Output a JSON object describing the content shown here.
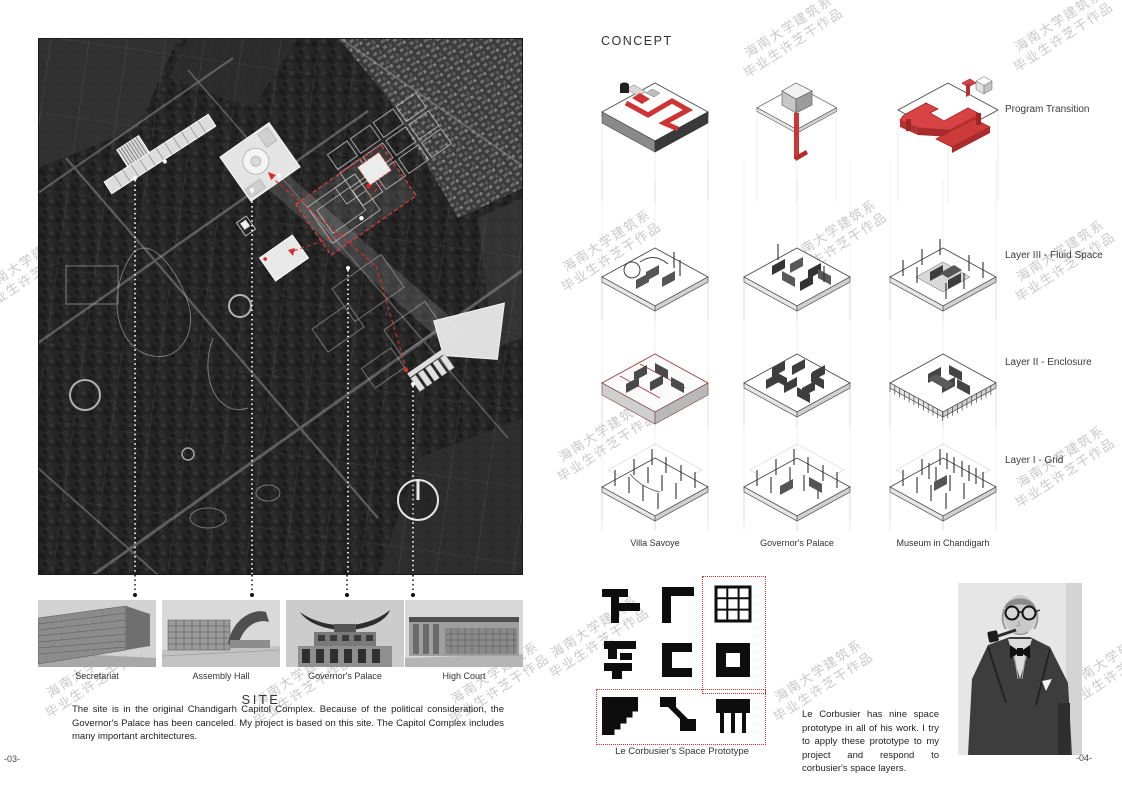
{
  "pages": {
    "left": "-03-",
    "right": "-04-"
  },
  "watermark": {
    "line1": "海南大学建筑系",
    "line2": "毕业生许芝干作品",
    "color": "#c9c9c9",
    "positions": [
      {
        "x": 1012,
        "y": 42
      },
      {
        "x": 1014,
        "y": 272
      },
      {
        "x": 1014,
        "y": 478
      },
      {
        "x": -20,
        "y": 282
      },
      {
        "x": 44,
        "y": 688
      },
      {
        "x": 252,
        "y": 696
      },
      {
        "x": 448,
        "y": 694
      },
      {
        "x": 742,
        "y": 48
      },
      {
        "x": 560,
        "y": 262
      },
      {
        "x": 556,
        "y": 452
      },
      {
        "x": 786,
        "y": 252
      },
      {
        "x": 548,
        "y": 648
      },
      {
        "x": 772,
        "y": 692
      },
      {
        "x": 1066,
        "y": 678
      }
    ]
  },
  "site": {
    "title": "SITE",
    "body": "The site is in the original Chandigarh Capitol Complex. Because of the political consideration, the Governor's Palace has been canceled. My project is based on this site. The Capitol Complex includes many important architectures.",
    "photo_captions": [
      "Secretariat",
      "Assembly Hall",
      "Governor's Palace",
      "High Court"
    ],
    "map": {
      "compass": "north-indicator",
      "highlight_color": "#e03030"
    }
  },
  "concept": {
    "title": "CONCEPT",
    "row_labels": [
      "Program Transition",
      "Layer III - Fluid Space",
      "Layer II - Enclosure",
      "Layer I - Grid"
    ],
    "column_labels": [
      "Villa Savoye",
      "Governor's Palace",
      "Museum in Chandigarh"
    ],
    "prototype_caption": "Le Corbusier's Space Prototype",
    "body": "Le Corbusier has nine space prototype in all of his work. I try to apply these prototype to my project and respond to corbusier's space layers.",
    "accent_red": "#d04040",
    "glyphs": [
      "tee-shape",
      "gamma-shape",
      "nine-grid",
      "beam-shape",
      "c-shape",
      "square-ring",
      "stair-corner-square",
      "ramp-shape",
      "slab-on-legs"
    ]
  }
}
